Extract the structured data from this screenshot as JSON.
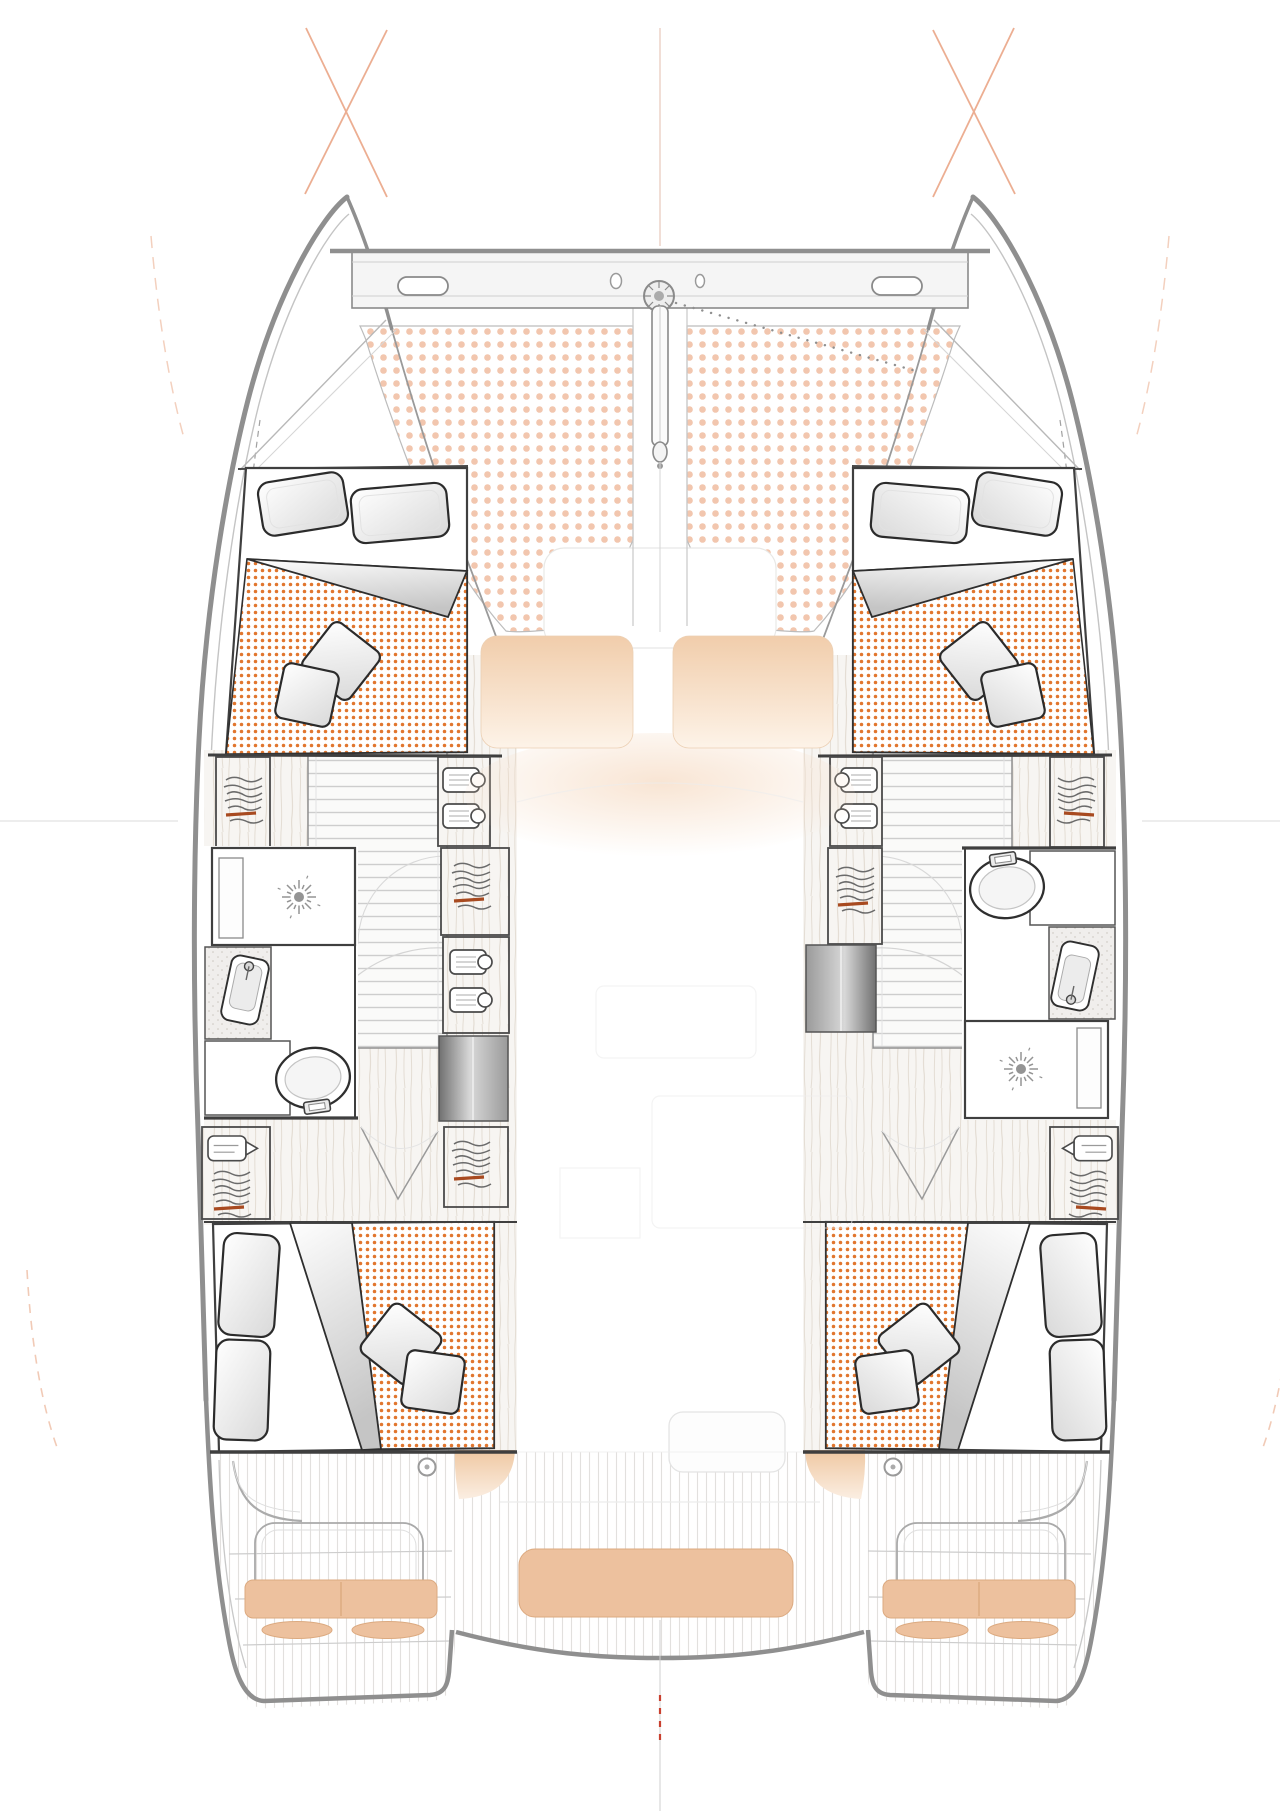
{
  "meta": {
    "title": "Catamaran four-cabin interior layout — top-down floor plan drawing"
  },
  "colors": {
    "background": "#ffffff",
    "hullLine": "#8f8f8f",
    "hullLineLight": "#c4c4c4",
    "wallLine": "#3f3f3f",
    "fixtureLine": "#2f2f2f",
    "detailLine": "#9a9a9a",
    "ghostLine": "#ececec",
    "duvetDot": "#e1762e",
    "trampolineDot": "#f2c6ae",
    "cushionPeach": "#edc19e",
    "cushionPadTop": "#f1cdab",
    "woodBase": "#f7f5f2",
    "woodGrain": "#e4ddd4",
    "teakLine": "#e2e0de",
    "treadLine": "#cdcdcd",
    "speckleBase": "#f0eeec",
    "clutterAccent": "#a84a20",
    "guideOrange": "#e89a77",
    "guidePeach": "#f0c4ae",
    "redDash": "#c9402f",
    "doorDark": "#707070",
    "doorLight": "#d8d8d8"
  },
  "components": {
    "hull_port": "port hull",
    "hull_starboard": "starboard hull",
    "bow_crossbeam": "bow crossbeam with forestay fitting",
    "bowsprit": "bowsprit pole",
    "trampoline_port": "port trampoline net panel",
    "trampoline_starboard": "starboard trampoline net panel",
    "foredeck_sunpads": "foredeck seat pads",
    "forward_cabin_port": "forward double cabin (port)",
    "forward_cabin_starboard": "forward double cabin (starboard)",
    "aft_cabin_port": "aft double cabin (port)",
    "aft_cabin_starboard": "aft double cabin (starboard)",
    "bathroom_port": "port bathroom: shower, sink, toilet",
    "bathroom_starboard": "starboard bathroom: toilet, sink, shower",
    "stairs_port": "port companionway stairs",
    "stairs_starboard": "starboard companionway stairs",
    "wardrobes": "hanging lockers and shelved wardrobes",
    "cockpit_bench_center": "aft cockpit center bench cushion",
    "cockpit_bench_port": "port transom bench cushion",
    "cockpit_bench_starboard": "starboard transom bench cushion",
    "swim_platform_port": "port swim platform steps",
    "swim_platform_starboard": "starboard swim platform steps",
    "rigging_guides": "rigging guide lines at bows",
    "centerline": "vessel centerline marker"
  }
}
